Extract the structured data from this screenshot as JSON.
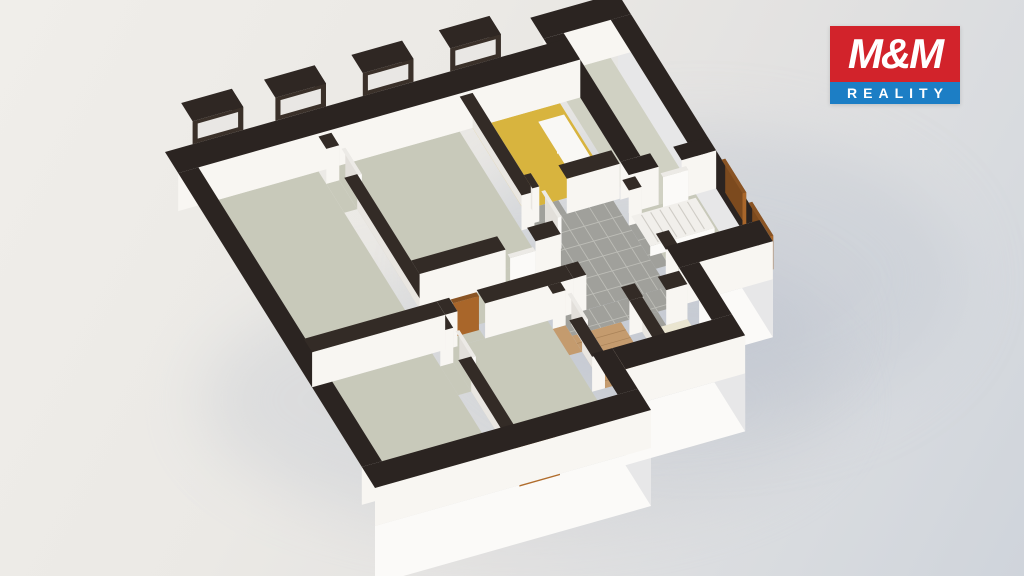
{
  "logo": {
    "title": "M&M",
    "subtitle": "REALITY",
    "red": "#d2232b",
    "blue": "#1c7ec5",
    "box": {
      "right": 64,
      "top": 26,
      "width": 130,
      "top_h": 56,
      "bottom_h": 22,
      "title_size": 42,
      "subtitle_size": 14,
      "subtitle_spacing": 6
    }
  },
  "colors": {
    "wall_top_ext": "#2b2421",
    "wall_top_int": "#332b26",
    "wall_face_v": "#f8f6f2",
    "wall_face_u": "#e9e6e1",
    "plinth_v": "#fbfaf8",
    "plinth_u": "#e7e7e8",
    "floor_gray": "#c8c9ba",
    "floor_balcony": "#d0d1c3",
    "floor_yellow": "#d8b43e",
    "floor_wood": "#c49b6e",
    "floor_cream": "#eae5d0",
    "floor_tile": "#a0a09b",
    "tile_grout": "#bdbdb7",
    "plank_line": "#7a5630",
    "box_dark_top": "#2f2723",
    "box_dark_v": "#3a3029",
    "box_dark_u": "#241e1a",
    "wood_top": "#8a5a26",
    "wood_v": "#b06c2c",
    "wood_u": "#8f5722",
    "wood_hole": "#4a3014",
    "door_top": "#8a5424",
    "door_v": "#a9662a",
    "door_u": "#7c4a1e",
    "white_top": "#eceae6",
    "white_v": "#fbfaf8",
    "white_u": "#e2dfda",
    "stair_top": "#f1efeb",
    "stair_v": "#fbfaf8",
    "stair_u": "#e5e2dd",
    "stair_tread": "#cfccc6",
    "bg_hole": "#e9e7e4",
    "shadow1": "#c3c9d3",
    "shadow2": "#c9cdd4",
    "shadow3": "#b9bfcc"
  },
  "scene": {
    "origin": [
      165,
      190
    ],
    "u_axis": [
      46,
      -13
    ],
    "v_axis": [
      30,
      48
    ],
    "wall_h_ext": 38,
    "wall_h_int": 35,
    "plinth_depth": 58,
    "plinth_edges": [
      {
        "type": "v",
        "x1": 0,
        "x2": 6.0,
        "y": 7.0
      },
      {
        "type": "u",
        "x": 6.0,
        "y1": 6.15,
        "y2": 7.0
      },
      {
        "type": "v",
        "x1": 6.0,
        "x2": 8.6,
        "y": 6.15
      },
      {
        "type": "u",
        "x": 8.6,
        "y1": 4.62,
        "y2": 6.15
      },
      {
        "type": "v",
        "x1": 8.6,
        "x2": 10.2,
        "y": 4.62
      },
      {
        "type": "u",
        "x": 10.2,
        "y1": -0.55,
        "y2": 4.62
      }
    ],
    "floors": [
      {
        "name": "bedroom-1",
        "r": [
          0.44,
          0.44,
          3.05,
          3.95
        ],
        "c": "floor_gray"
      },
      {
        "name": "bedroom-2",
        "r": [
          3.33,
          0.44,
          6.12,
          3.1
        ],
        "c": "floor_gray"
      },
      {
        "name": "children-room",
        "r": [
          6.4,
          0.44,
          8.3,
          2.15
        ],
        "c": "floor_yellow"
      },
      {
        "name": "corridor",
        "r": [
          3.33,
          3.38,
          6.4,
          3.95
        ],
        "c": "floor_gray"
      },
      {
        "name": "dining-room",
        "r": [
          3.33,
          4.23,
          5.56,
          6.56
        ],
        "c": "floor_gray"
      },
      {
        "name": "bedroom-3",
        "r": [
          0.44,
          4.23,
          3.05,
          6.56
        ],
        "c": "floor_gray"
      },
      {
        "name": "living-room",
        "r": [
          8.44,
          2.73,
          9.76,
          4.18
        ],
        "c": "floor_gray"
      },
      {
        "name": "balcony",
        "r": [
          8.44,
          -0.11,
          9.76,
          2.45
        ],
        "c": "floor_balcony"
      },
      {
        "name": "doorway-1",
        "r": [
          3.05,
          0.7,
          3.33,
          1.3
        ],
        "c": "floor_gray"
      },
      {
        "name": "doorway-2",
        "r": [
          5.2,
          3.1,
          5.85,
          3.38
        ],
        "c": "floor_gray"
      },
      {
        "name": "doorway-3",
        "r": [
          3.6,
          3.95,
          4.2,
          4.23
        ],
        "c": "floor_gray"
      },
      {
        "name": "doorway-4",
        "r": [
          3.05,
          4.5,
          3.33,
          5.1
        ],
        "c": "floor_gray"
      },
      {
        "name": "doorway-5",
        "r": [
          5.56,
          4.4,
          5.84,
          4.95
        ],
        "c": "floor_wood"
      },
      {
        "name": "doorway-6",
        "r": [
          8.95,
          2.45,
          9.45,
          2.73
        ],
        "c": "floor_balcony"
      },
      {
        "name": "bathroom",
        "r": [
          5.84,
          4.62,
          6.9,
          5.71
        ],
        "c": "floor_wood",
        "planks": true
      },
      {
        "name": "wc",
        "r": [
          7.18,
          4.9,
          8.16,
          5.71
        ],
        "c": "floor_cream"
      }
    ],
    "tile_regions": [
      {
        "name": "hall-tiles-main",
        "r": [
          6.4,
          2.43,
          8.16,
          4.23
        ]
      },
      {
        "name": "hall-tiles-south",
        "r": [
          5.84,
          4.23,
          8.16,
          4.62
        ]
      },
      {
        "name": "hall-tiles-wc",
        "r": [
          7.2,
          4.62,
          7.7,
          4.9
        ]
      },
      {
        "name": "hall-tiles-door",
        "r": [
          6.55,
          2.15,
          7.15,
          2.43
        ]
      },
      {
        "name": "hall-tiles-east",
        "r": [
          8.16,
          2.95,
          8.44,
          3.85
        ]
      }
    ],
    "tile_step": 0.31,
    "walls_ext": [
      [
        0,
        0,
        8.74,
        0.44
      ],
      [
        0,
        0.44,
        0.44,
        6.56
      ],
      [
        0,
        6.56,
        6.0,
        7.0
      ],
      [
        5.56,
        5.71,
        6.0,
        6.56
      ],
      [
        6.0,
        5.71,
        8.6,
        6.15
      ],
      [
        8.16,
        4.62,
        8.6,
        5.71
      ],
      [
        8.16,
        4.18,
        10.2,
        4.62
      ],
      [
        9.76,
        -0.11,
        10.2,
        4.18
      ],
      [
        8.3,
        -0.55,
        10.2,
        -0.11
      ],
      [
        8.3,
        -0.11,
        8.74,
        2.45
      ],
      [
        8.3,
        2.45,
        8.95,
        2.73
      ],
      [
        9.45,
        2.45,
        10.2,
        2.73
      ]
    ],
    "walls_int": [
      [
        3.05,
        0.44,
        3.33,
        0.7
      ],
      [
        3.05,
        1.3,
        3.33,
        3.95
      ],
      [
        0.44,
        3.95,
        3.33,
        4.23
      ],
      [
        3.33,
        3.1,
        5.2,
        3.38
      ],
      [
        5.85,
        3.1,
        6.4,
        3.38
      ],
      [
        3.33,
        3.95,
        3.6,
        4.23
      ],
      [
        4.2,
        3.95,
        6.12,
        4.23
      ],
      [
        6.12,
        3.95,
        6.4,
        4.23
      ],
      [
        6.12,
        0.44,
        6.4,
        2.5
      ],
      [
        7.15,
        2.15,
        8.3,
        2.43
      ],
      [
        6.4,
        2.15,
        6.55,
        2.43
      ],
      [
        8.16,
        2.73,
        8.44,
        2.95
      ],
      [
        8.16,
        3.85,
        8.44,
        4.18
      ],
      [
        6.9,
        4.62,
        7.2,
        4.9
      ],
      [
        7.7,
        4.62,
        8.16,
        4.9
      ],
      [
        6.9,
        4.9,
        7.18,
        5.71
      ],
      [
        5.56,
        4.23,
        5.84,
        4.4
      ],
      [
        5.56,
        4.95,
        5.84,
        5.71
      ],
      [
        3.05,
        4.23,
        3.33,
        4.5
      ],
      [
        3.05,
        5.1,
        3.33,
        6.56
      ]
    ],
    "window_boxes": [
      {
        "name": "window-box-1",
        "r": [
          0.6,
          -0.38,
          1.7,
          0.0
        ]
      },
      {
        "name": "window-box-2",
        "r": [
          2.4,
          -0.38,
          3.5,
          0.0
        ]
      },
      {
        "name": "window-box-3",
        "r": [
          4.3,
          -0.38,
          5.4,
          0.0
        ]
      },
      {
        "name": "window-box-4",
        "r": [
          6.2,
          -0.38,
          7.3,
          0.0
        ]
      }
    ],
    "window_box_base": 38,
    "window_box_h": 23,
    "wood_windows": [
      {
        "name": "wood-window-south",
        "r": [
          3.1,
          6.52,
          3.98,
          7.06
        ],
        "base": 2,
        "h": 32
      }
    ],
    "doors_wood": [
      {
        "name": "interior-door-wood",
        "r": [
          3.62,
          3.97,
          4.18,
          4.05
        ],
        "h": 34
      },
      {
        "name": "entry-door-1",
        "r": [
          10.24,
          2.85,
          10.32,
          3.55
        ],
        "h": 34
      },
      {
        "name": "entry-door-2",
        "r": [
          10.24,
          3.75,
          10.32,
          4.45
        ],
        "h": 34
      }
    ],
    "doors_white": [
      {
        "name": "white-door-1",
        "r": [
          3.37,
          0.72,
          3.45,
          1.27
        ],
        "h": 32
      },
      {
        "name": "white-door-2",
        "r": [
          6.57,
          2.47,
          6.65,
          3.02
        ],
        "h": 32
      },
      {
        "name": "white-door-3",
        "r": [
          5.22,
          3.42,
          5.77,
          3.5
        ],
        "h": 32
      },
      {
        "name": "white-door-4",
        "r": [
          3.37,
          4.52,
          3.45,
          5.07
        ],
        "h": 32
      },
      {
        "name": "white-door-5",
        "r": [
          5.87,
          4.42,
          5.95,
          4.97
        ],
        "h": 32
      },
      {
        "name": "white-door-6",
        "r": [
          8.98,
          2.75,
          9.53,
          2.83
        ],
        "h": 32
      }
    ],
    "furniture": [
      {
        "name": "bed-base",
        "r": [
          7.58,
          0.82,
          8.14,
          2.0
        ],
        "h": 9,
        "c": "white"
      },
      {
        "name": "bed-pillow",
        "r": [
          7.66,
          0.95,
          8.06,
          1.32
        ],
        "h": 14,
        "c": "white"
      }
    ],
    "stairs": {
      "name": "staircase",
      "r": [
        8.2,
        2.97,
        9.6,
        3.6
      ],
      "h": 10,
      "treads": 7
    },
    "ground_shadows": [
      {
        "cx": 700,
        "cy": 280,
        "rx": 260,
        "ry": 150,
        "c": "shadow1",
        "o": 0.5
      },
      {
        "cx": 520,
        "cy": 400,
        "rx": 320,
        "ry": 130,
        "c": "shadow2",
        "o": 0.45
      },
      {
        "cx": 660,
        "cy": 330,
        "rx": 180,
        "ry": 80,
        "c": "shadow3",
        "o": 0.35
      }
    ]
  }
}
